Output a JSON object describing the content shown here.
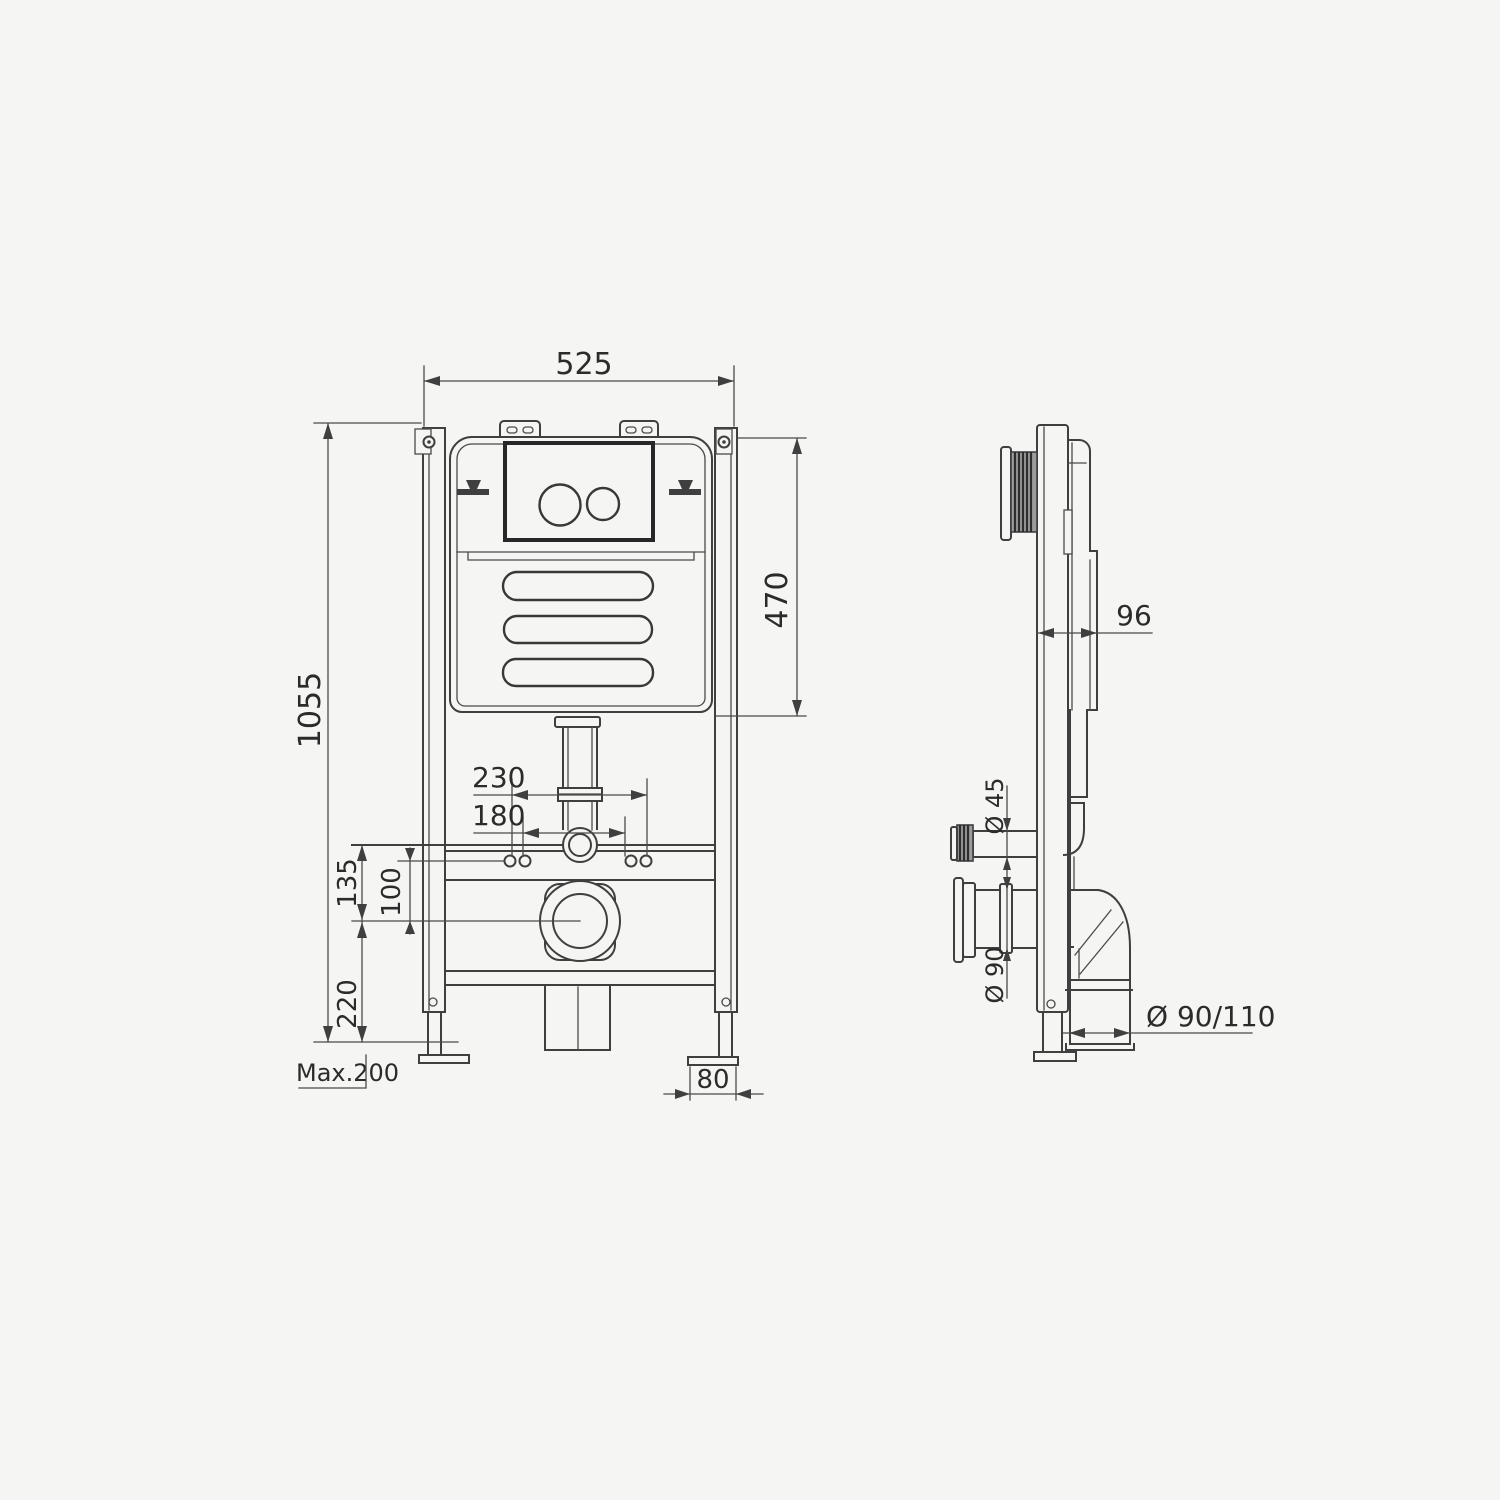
{
  "colors": {
    "line": "#3f3f3f",
    "background": "#f5f5f3"
  },
  "front_view": {
    "dims": {
      "frame_width": "525",
      "frame_height": "1055",
      "cistern_height": "470",
      "fixing_bolts_outer": "230",
      "fixing_bolts_inner": "180",
      "flush_rail_to_outlet": "135",
      "bolts_to_outlet": "100",
      "outlet_to_floor": "220",
      "foot_adjustment": "Max.200",
      "foot_plate_width": "80"
    }
  },
  "side_view": {
    "dims": {
      "frame_depth": "96",
      "flush_pipe_diameter": "Ø 45",
      "outlet_connector_diameter": "Ø 90",
      "waste_elbow_diameter": "Ø 90/110"
    }
  }
}
